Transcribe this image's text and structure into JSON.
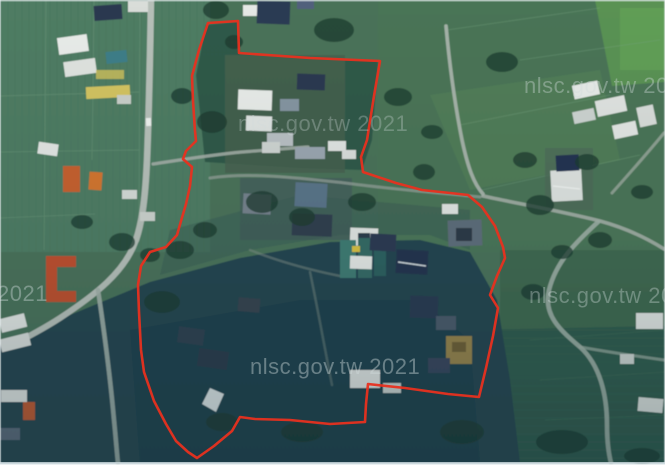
{
  "watermarks": {
    "color": "#d2dcdc",
    "items": [
      {
        "id": "top-center",
        "text": "nlsc.gov.tw 2021"
      },
      {
        "id": "top-right",
        "text": "nlsc.gov.tw 202"
      },
      {
        "id": "mid-left",
        "text": "2021"
      },
      {
        "id": "mid-right",
        "text": "nlsc.gov.tw 20"
      },
      {
        "id": "bottom-center",
        "text": "nlsc.gov.tw 2021"
      }
    ]
  },
  "boundary": {
    "color": "#e8301f",
    "stroke_width": 2.6,
    "points": "208,23 238,21 239,53 310,58 380,61 374,96 367,140 361,157 363,172 396,183 422,190 450,193 468,195 482,207 495,226 503,247 505,258 497,276 490,295 498,308 493,336 486,368 479,397 448,394 405,388 368,384 366,404 365,422 330,424 290,420 255,419 240,417 232,431 214,446 197,458 188,452 176,441 166,424 154,401 144,372 141,350 139,312 138,285 141,266 150,252 166,247 177,235 181,221 186,204 190,186 192,167 183,159 186,151 196,141 195,131 193,101 192,76 199,50"
  }
}
